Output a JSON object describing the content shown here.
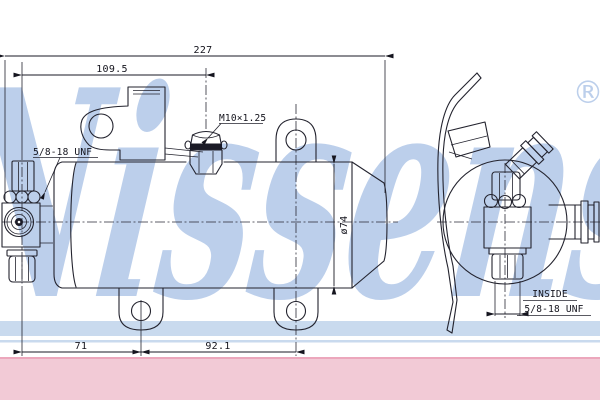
{
  "watermark": {
    "brand": "Nissens",
    "registered": "®",
    "color": "#bccfeb",
    "band_color": "#c9daee"
  },
  "footer_band": {
    "color": "#f2cad6",
    "edge_color": "#eca7bc"
  },
  "drawing": {
    "dims": {
      "total_length": "227",
      "port_to_stud": "109.5",
      "diameter": "ø74",
      "port_to_tab": "71",
      "tab_spacing": "92.1"
    },
    "labels": {
      "stud_thread": "M10×1.25",
      "side_port_thread": "5/8-18 UNF",
      "end_port_line1": "INSIDE",
      "end_port_line2": "5/8-18 UNF"
    }
  }
}
